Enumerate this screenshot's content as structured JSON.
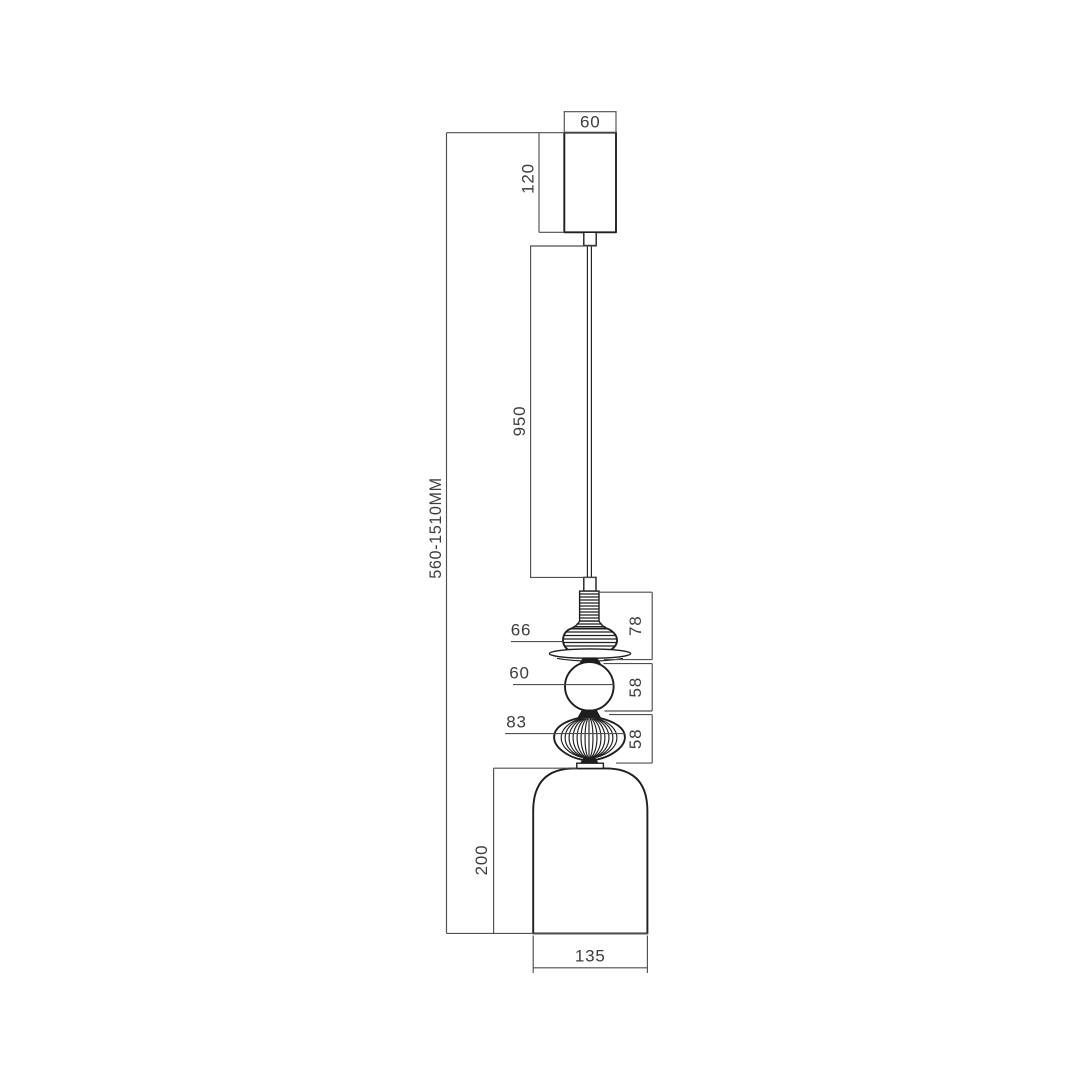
{
  "drawing": {
    "kind": "pendant-lamp-dimension-drawing",
    "colors": {
      "background": "#ffffff",
      "object_line": "#1f1f1f",
      "dimension_line": "#4f4f4f",
      "label_text": "#3d3d3d"
    },
    "labels": {
      "canopy_width": "60",
      "canopy_height": "120",
      "cord_length": "950",
      "overall_height": "560-1510MM",
      "finial_width": "66",
      "finial_stack_height": "78",
      "sphere_width": "60",
      "sphere_height": "58",
      "diffuser_width": "83",
      "diffuser_height": "58",
      "shade_height": "200",
      "shade_width": "135"
    }
  }
}
